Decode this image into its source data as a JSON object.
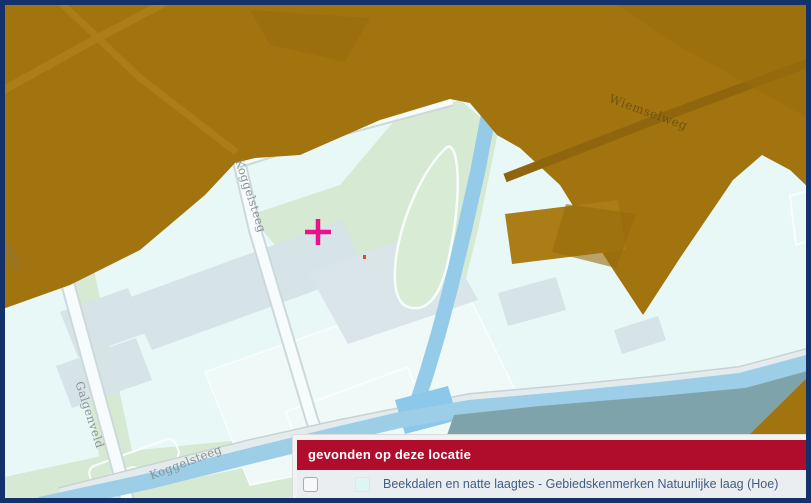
{
  "window": {
    "border_color": "#15316b"
  },
  "map": {
    "street_labels": [
      {
        "id": "koggelsteeg-north",
        "text": "Koggelsteeg"
      },
      {
        "id": "galgenveld",
        "text": "Galgenveld"
      },
      {
        "id": "veld-partial",
        "text": "veld"
      },
      {
        "id": "koggelsteeg-south",
        "text": "Koggelsteeg"
      },
      {
        "id": "wiemselweg",
        "text": "Wiemselweg"
      }
    ],
    "marker": {
      "type": "crosshair",
      "color": "#ec108c"
    },
    "theme_colors": {
      "overlay_brown": "#a1740f",
      "background_cyan": "#e7f8f7",
      "water_blue": "#9ccee8",
      "grass_green": "#d6e9d2",
      "building_gray": "#d6e3e7",
      "industrial_teal": "#7fa3aa"
    }
  },
  "popup": {
    "title": "gevonden op deze locatie",
    "title_bg": "#b00d2d",
    "items": [
      {
        "checked": false,
        "swatch_color": "#ddf6f4",
        "label": "Beekdalen en natte laagtes - Gebiedskenmerken Natuurlijke laag (Hoe)"
      }
    ]
  }
}
